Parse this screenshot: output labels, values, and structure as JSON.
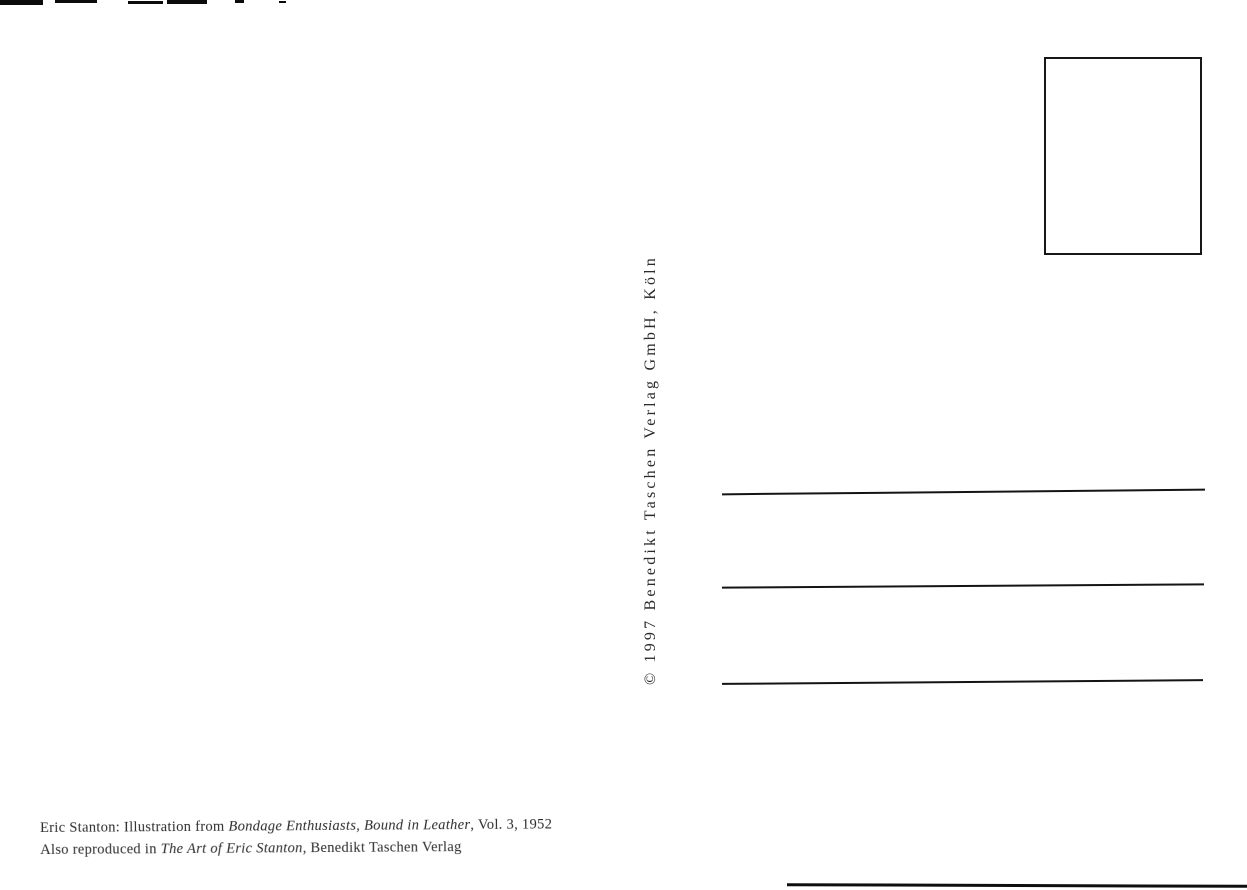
{
  "postcard": {
    "publisher_copyright": "© 1997 Benedikt Taschen Verlag GmbH, Köln",
    "caption": {
      "line1": {
        "prefix": "Eric Stanton: Illustration from ",
        "title_italic": "Bondage Enthusiasts, Bound in Leather",
        "suffix": ", Vol. 3, 1952"
      },
      "line2": {
        "prefix": "Also reproduced in ",
        "title_italic": "The Art of Eric Stanton",
        "suffix": ", Benedikt Taschen Verlag"
      }
    },
    "address_lines_count": 3,
    "colors": {
      "paper": "#ffffff",
      "ink": "#1a1a1a"
    }
  }
}
